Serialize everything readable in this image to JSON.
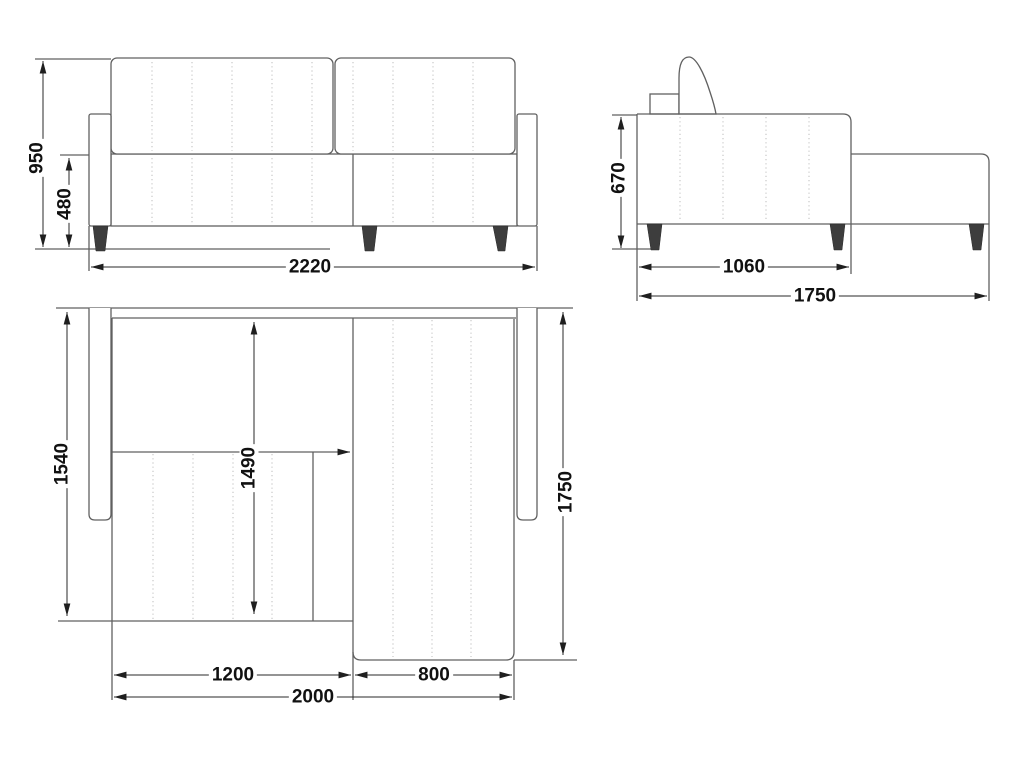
{
  "drawing": {
    "views": {
      "front": {
        "dimensions": {
          "overall_height": "950",
          "seat_height": "480",
          "overall_width": "2220"
        }
      },
      "side": {
        "dimensions": {
          "seat_back_height": "670",
          "sofa_body_depth": "1060",
          "overall_depth": "1750"
        }
      },
      "top": {
        "dimensions": {
          "left_section_depth": "1540",
          "inner_bed_depth": "1490",
          "chaise_overall_depth": "1750",
          "seat_section_width": "1200",
          "chaise_width": "800",
          "inner_width": "2000"
        }
      }
    },
    "colors": {
      "outline": "#606060",
      "stitch": "#c2c2c2",
      "dim": "#2a2a2a",
      "leg": "#3d3d3d",
      "text": "#111111",
      "bg": "#ffffff"
    }
  }
}
